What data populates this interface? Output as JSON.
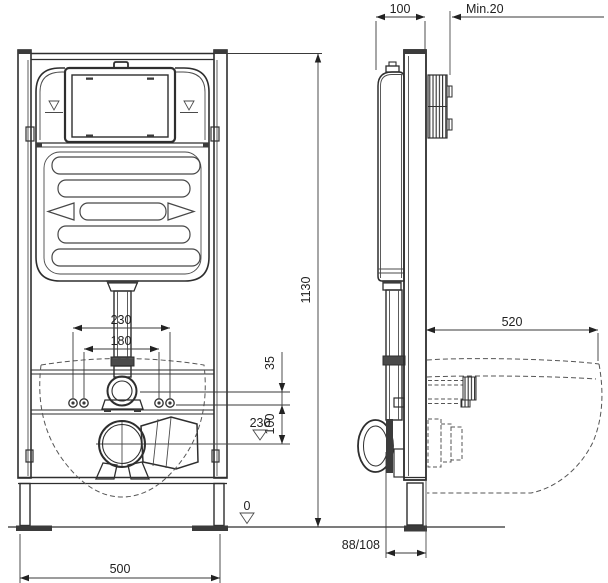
{
  "drawing": {
    "kind": "wall-hung-toilet-installation-frame",
    "views": {
      "front": "front elevation",
      "side": "side section"
    },
    "colors": {
      "line": "#2e2e2e",
      "background": "#ffffff"
    }
  },
  "dims": {
    "frame_depth": "100",
    "min_wall_clearance": "Min.20",
    "frame_height": "1130",
    "bowl_projection": "520",
    "fixing_bolts_outer": "230",
    "fixing_bolts_inner": "180",
    "supply_offset": "35",
    "drain_offset_v": "100",
    "drain_level": "230",
    "floor_level": "0",
    "outlet_distance": "88/108",
    "frame_width": "500"
  }
}
